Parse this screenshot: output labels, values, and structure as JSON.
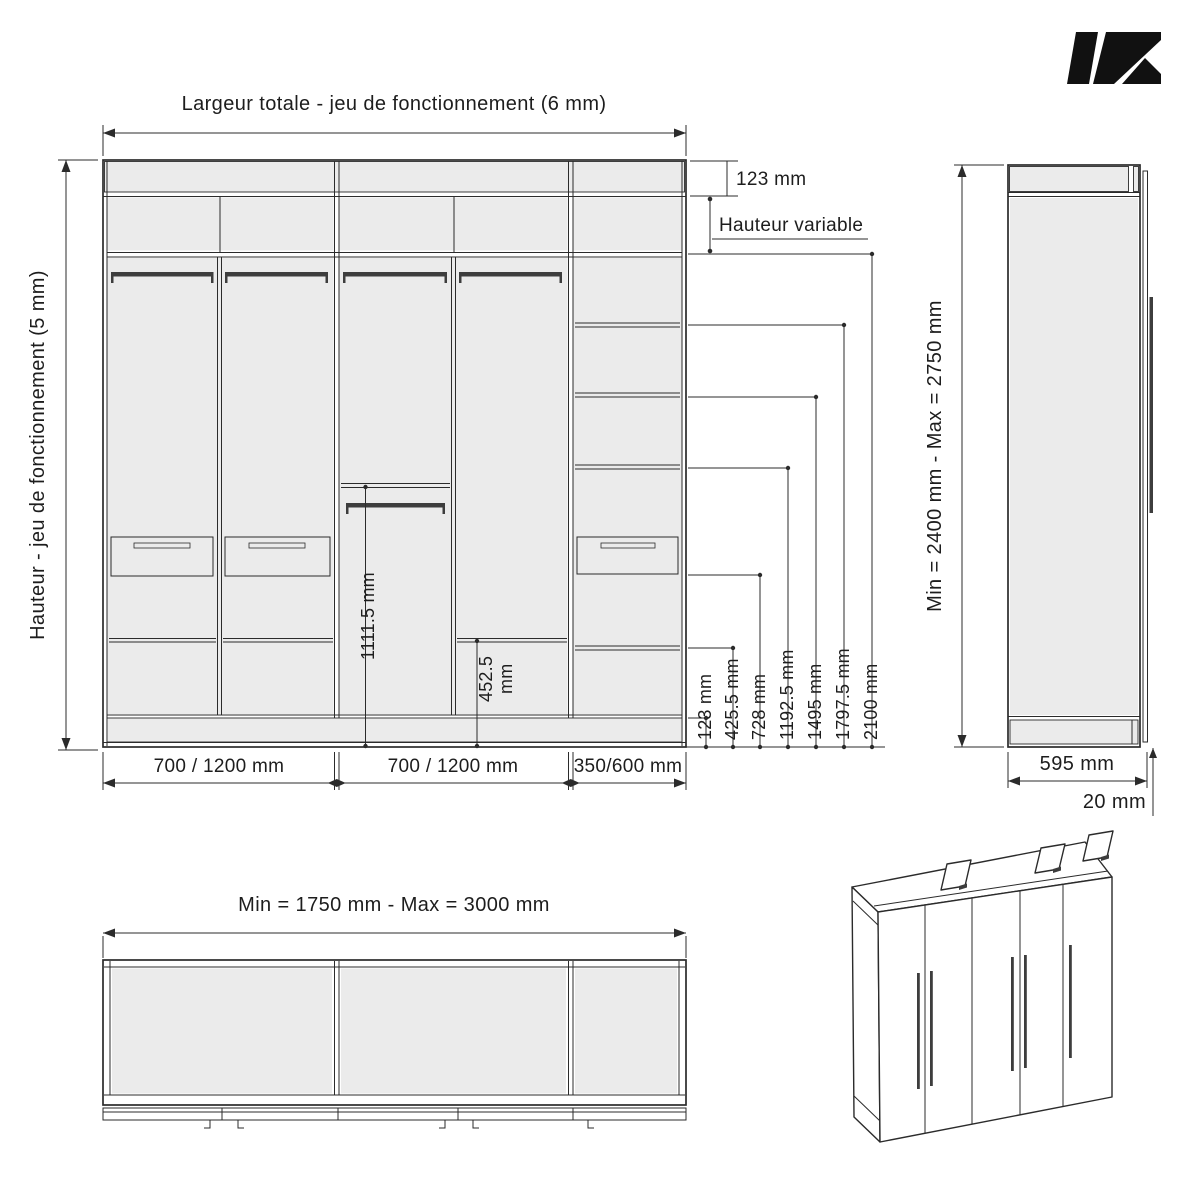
{
  "colors": {
    "background": "#ffffff",
    "panel_fill": "#ebebeb",
    "line": "#2b2b2b",
    "rod_dark": "#3d3d3d",
    "logo": "#111111"
  },
  "front_view": {
    "width_label": "Largeur totale - jeu de fonctionnement (6 mm)",
    "height_label": "Hauteur - jeu de fonctionnement (5 mm)",
    "top_offset_label": "123 mm",
    "variable_height_label": "Hauteur variable",
    "hang_dim_label": "1111.5 mm",
    "shelf_dim_line1": "452.5",
    "shelf_dim_line2": "mm",
    "ladder_dims": [
      "123 mm",
      "425.5 mm",
      "728 mm",
      "1192.5 mm",
      "1495 mm",
      "1797.5 mm",
      "2100 mm"
    ],
    "section_widths": [
      "700 / 1200 mm",
      "700 / 1200 mm",
      "350/600 mm"
    ]
  },
  "side_view": {
    "height_range_label": "Min = 2400 mm - Max = 2750 mm",
    "depth_label": "595 mm",
    "door_thickness_label": "20 mm"
  },
  "top_view": {
    "width_range_label": "Min = 1750 mm - Max = 3000 mm"
  }
}
